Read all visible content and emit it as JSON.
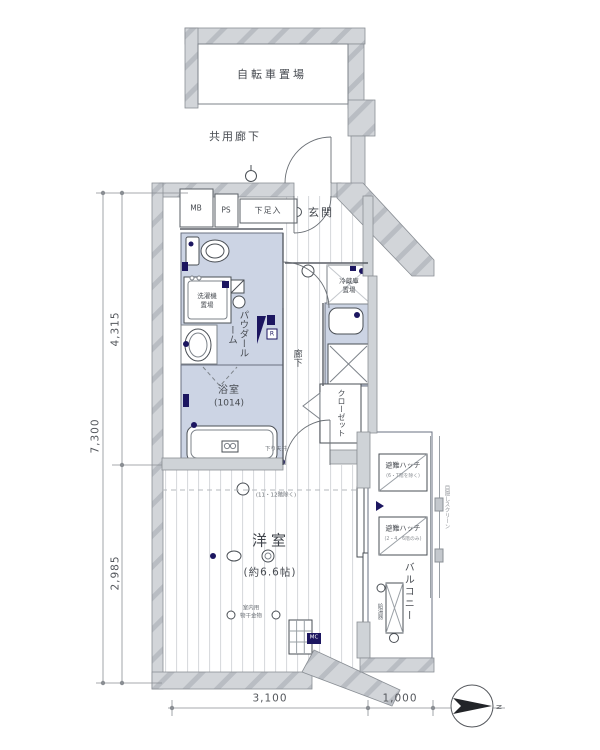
{
  "labels": {
    "bicycle_area": "自転車置場",
    "common_corridor": "共用廊下",
    "meter_box": "MB",
    "pipe_space": "PS",
    "shoe_cabinet": "下足入",
    "entrance": "玄関",
    "washing_machine_line1": "洗濯機",
    "washing_machine_line2": "置場",
    "powder_room": "パウダールーム",
    "bathroom": "浴室",
    "bathroom_size": "(1014)",
    "corridor": "廊下",
    "refrigerator_line1": "冷蔵庫",
    "refrigerator_line2": "置場",
    "closet": "クローゼット",
    "lowered_ceiling": "下り天井",
    "lowered_ceiling_note": "(11・12階除く)",
    "western_room": "洋室",
    "western_room_size": "(約6.6帖)",
    "indoor_drying_line1": "室内用",
    "indoor_drying_line2": "物干金物",
    "mc": "MC",
    "remote_controller": "R",
    "escape_hatch_upper": "避難ハッチ",
    "escape_hatch_upper_note": "(6・7階を除く)",
    "escape_hatch_lower": "避難ハッチ",
    "escape_hatch_lower_note": "(2・4・6階のみ)",
    "balcony": "バルコニー",
    "privacy_screen": "目隠しスクリーン",
    "water_heater": "給湯器"
  },
  "dimensions": {
    "left_total": "7,300",
    "left_upper": "4,315",
    "left_lower": "2,985",
    "bottom_main": "3,100",
    "bottom_balcony": "1,000"
  },
  "compass": {
    "north_label": "N"
  },
  "colors": {
    "wall_fill": "#d2d5d9",
    "wall_hatch": "#b9bdc3",
    "wet_area_fill": "#ccd4e4",
    "line": "#4a4f55",
    "fixture_navy": "#1c1660",
    "floor_stripe": "#d9dbde",
    "text": "#474b51"
  }
}
